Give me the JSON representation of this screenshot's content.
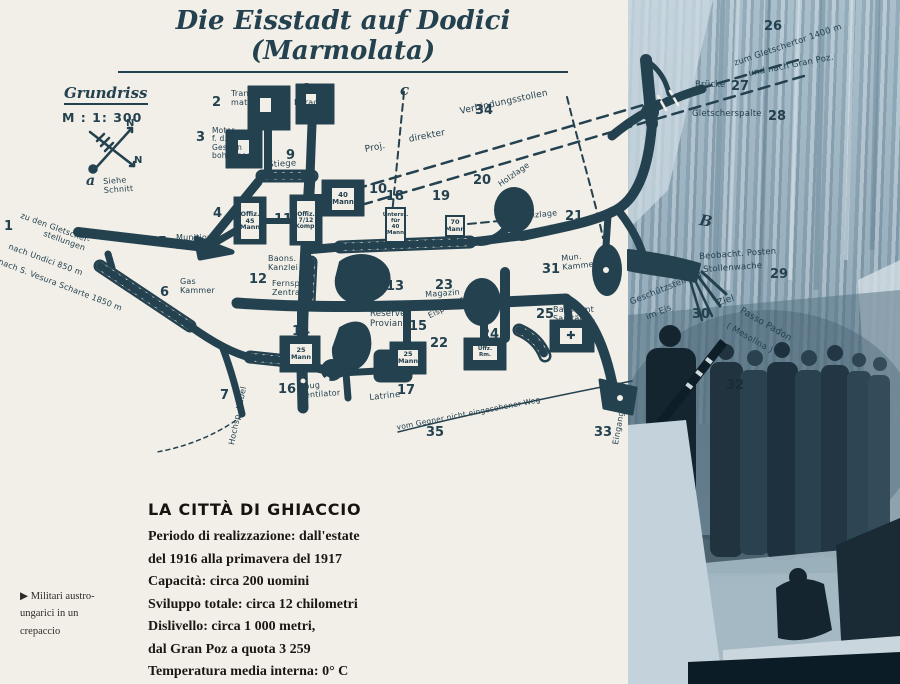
{
  "title": "Die Eisstadt auf Dodici (Marmolata)",
  "legend": {
    "name": "Grundriss",
    "scale": "M : 1: 300",
    "compass_n1": "N",
    "compass_n2": "N"
  },
  "caption": {
    "heading": "LA CITTÀ DI GHIACCIO",
    "lines": [
      "Periodo di realizzazione: dall'estate",
      "del 1916 alla primavera del 1917",
      "Capacità: circa 200 uomini",
      "Sviluppo totale: circa 12 chilometri",
      "Dislivello: circa 1 000 metri,",
      "dal Gran Poz a quota 3 259",
      "Temperatura media interna: 0° C"
    ]
  },
  "photo_note": {
    "marker": "▶",
    "lines": [
      "Militari austro-",
      "ungarici in un",
      "crepaccio"
    ]
  },
  "colors": {
    "ink": "#24414f",
    "paper": "#f2efe8",
    "photo_dark": "#15262f"
  },
  "map_labels": [
    {
      "t": "1",
      "x": 4,
      "y": 220,
      "s": 13,
      "n": 1
    },
    {
      "t": "2",
      "x": 212,
      "y": 96,
      "s": 13,
      "n": 1
    },
    {
      "t": "3",
      "x": 196,
      "y": 131,
      "s": 13,
      "n": 1
    },
    {
      "t": "4",
      "x": 213,
      "y": 207,
      "s": 13,
      "n": 1
    },
    {
      "t": "5",
      "x": 158,
      "y": 236,
      "s": 13,
      "n": 1
    },
    {
      "t": "6",
      "x": 160,
      "y": 286,
      "s": 13,
      "n": 1
    },
    {
      "t": "7",
      "x": 220,
      "y": 389,
      "s": 13,
      "n": 1
    },
    {
      "t": "8",
      "x": 302,
      "y": 83,
      "s": 13,
      "n": 1
    },
    {
      "t": "9",
      "x": 286,
      "y": 149,
      "s": 13,
      "n": 1
    },
    {
      "t": "10",
      "x": 369,
      "y": 183,
      "s": 13,
      "n": 1
    },
    {
      "t": "11",
      "x": 274,
      "y": 213,
      "s": 13,
      "n": 1
    },
    {
      "t": "12",
      "x": 249,
      "y": 273,
      "s": 13,
      "n": 1
    },
    {
      "t": "13",
      "x": 386,
      "y": 280,
      "s": 13,
      "n": 1
    },
    {
      "t": "14",
      "x": 292,
      "y": 325,
      "s": 13,
      "n": 1
    },
    {
      "t": "15",
      "x": 409,
      "y": 320,
      "s": 13,
      "n": 1
    },
    {
      "t": "16",
      "x": 278,
      "y": 383,
      "s": 13,
      "n": 1
    },
    {
      "t": "17",
      "x": 397,
      "y": 384,
      "s": 13,
      "n": 1
    },
    {
      "t": "18",
      "x": 386,
      "y": 190,
      "s": 13,
      "n": 1
    },
    {
      "t": "19",
      "x": 432,
      "y": 190,
      "s": 13,
      "n": 1
    },
    {
      "t": "20",
      "x": 473,
      "y": 174,
      "s": 13,
      "n": 1
    },
    {
      "t": "21",
      "x": 565,
      "y": 210,
      "s": 13,
      "n": 1
    },
    {
      "t": "22",
      "x": 430,
      "y": 337,
      "s": 13,
      "n": 1
    },
    {
      "t": "23",
      "x": 435,
      "y": 279,
      "s": 13,
      "n": 1
    },
    {
      "t": "24",
      "x": 481,
      "y": 328,
      "s": 13,
      "n": 1
    },
    {
      "t": "25",
      "x": 536,
      "y": 308,
      "s": 13,
      "n": 1
    },
    {
      "t": "26",
      "x": 764,
      "y": 20,
      "s": 13,
      "n": 1
    },
    {
      "t": "27",
      "x": 731,
      "y": 80,
      "s": 13,
      "n": 1
    },
    {
      "t": "28",
      "x": 768,
      "y": 110,
      "s": 13,
      "n": 1
    },
    {
      "t": "29",
      "x": 770,
      "y": 268,
      "s": 13,
      "n": 1
    },
    {
      "t": "30",
      "x": 692,
      "y": 308,
      "s": 13,
      "n": 1
    },
    {
      "t": "31",
      "x": 542,
      "y": 263,
      "s": 13,
      "n": 1
    },
    {
      "t": "32",
      "x": 726,
      "y": 379,
      "s": 13,
      "n": 1,
      "c": "dark"
    },
    {
      "t": "33",
      "x": 594,
      "y": 426,
      "s": 13,
      "n": 1
    },
    {
      "t": "34",
      "x": 475,
      "y": 104,
      "s": 13,
      "n": 1
    },
    {
      "t": "35",
      "x": 426,
      "y": 426,
      "s": 13,
      "n": 1
    },
    {
      "t": "a",
      "x": 86,
      "y": 174,
      "s": 14,
      "i": 1
    },
    {
      "t": "Siehe\nSchnitt",
      "x": 103,
      "y": 178,
      "s": 8,
      "r": -4
    },
    {
      "t": "c",
      "x": 400,
      "y": 82,
      "s": 15,
      "i": 1
    },
    {
      "t": "B",
      "x": 701,
      "y": 212,
      "s": 15,
      "i": 1,
      "r": 10
    },
    {
      "t": "Transfor-\nmator",
      "x": 231,
      "y": 90,
      "s": 8
    },
    {
      "t": "Motor\nf. d.\nGestein\nbohrmasch.",
      "x": 212,
      "y": 127,
      "s": 7.5
    },
    {
      "t": "Baracke",
      "x": 294,
      "y": 99,
      "s": 8
    },
    {
      "t": "Stiege",
      "x": 268,
      "y": 161,
      "s": 8.5,
      "r": -3
    },
    {
      "t": "zu den Gletscher-",
      "x": 22,
      "y": 212,
      "s": 8,
      "r": 20
    },
    {
      "t": "stellungen",
      "x": 45,
      "y": 230,
      "s": 8,
      "r": 20
    },
    {
      "t": "nach Undici 850 m",
      "x": 10,
      "y": 243,
      "s": 8,
      "r": 20
    },
    {
      "t": "nach S. Vesura Scharte 1850 m",
      "x": 0,
      "y": 258,
      "s": 8,
      "r": 21
    },
    {
      "t": "Proj.",
      "x": 364,
      "y": 145,
      "s": 9,
      "r": -11
    },
    {
      "t": "direkter",
      "x": 408,
      "y": 135,
      "s": 9,
      "r": -11
    },
    {
      "t": "Verbindungsstollen",
      "x": 459,
      "y": 107,
      "s": 9,
      "r": -12
    },
    {
      "t": "Holzlage",
      "x": 497,
      "y": 182,
      "s": 8,
      "r": -35
    },
    {
      "t": "Holzlage",
      "x": 521,
      "y": 213,
      "s": 8,
      "r": -6
    },
    {
      "t": "stufen",
      "x": 536,
      "y": 227,
      "s": 8,
      "r": -8
    },
    {
      "t": "Mun.\nKammer",
      "x": 561,
      "y": 255,
      "s": 8,
      "r": -6
    },
    {
      "t": "Munitions\nraum",
      "x": 176,
      "y": 234,
      "s": 8
    },
    {
      "t": "Gas\nKammer",
      "x": 180,
      "y": 278,
      "s": 8
    },
    {
      "t": "Baons.\nKanzlei",
      "x": 268,
      "y": 255,
      "s": 8
    },
    {
      "t": "Fernspr.\nZentrale",
      "x": 272,
      "y": 280,
      "s": 8
    },
    {
      "t": "Vorrats\nraum",
      "x": 357,
      "y": 270,
      "s": 8.5
    },
    {
      "t": "Magazin",
      "x": 425,
      "y": 291,
      "s": 8,
      "r": -4
    },
    {
      "t": "Eispfeiler",
      "x": 427,
      "y": 313,
      "s": 8,
      "r": -27
    },
    {
      "t": "Reserve\nProviant",
      "x": 370,
      "y": 310,
      "s": 8.5
    },
    {
      "t": "Baon Amt\nSanität",
      "x": 553,
      "y": 306,
      "s": 8
    },
    {
      "t": "Saug\nventilator",
      "x": 299,
      "y": 383,
      "s": 8,
      "r": -4
    },
    {
      "t": "Latrine",
      "x": 369,
      "y": 394,
      "s": 8.5,
      "r": -6
    },
    {
      "t": "Hochsp. Kabel",
      "x": 228,
      "y": 444,
      "s": 8,
      "r": -78
    },
    {
      "t": "vom Gegner nicht eingesehener Weg",
      "x": 396,
      "y": 424,
      "s": 7.5,
      "r": -11
    },
    {
      "t": "Eingang",
      "x": 612,
      "y": 444,
      "s": 8,
      "r": -80
    },
    {
      "t": "zum Gletschertor 1400 m",
      "x": 733,
      "y": 60,
      "s": 8.5,
      "r": -19
    },
    {
      "t": "und nach Gran Poz.",
      "x": 748,
      "y": 70,
      "s": 8.5,
      "r": -11
    },
    {
      "t": "Brücke",
      "x": 695,
      "y": 81,
      "s": 8.5
    },
    {
      "t": "Gletscherspalte",
      "x": 692,
      "y": 110,
      "s": 8.5
    },
    {
      "t": "Beobacht. Posten",
      "x": 699,
      "y": 253,
      "s": 8.5,
      "r": -4
    },
    {
      "t": "Stollenwache",
      "x": 703,
      "y": 266,
      "s": 8.5,
      "r": -4
    },
    {
      "t": "Geschützstellung",
      "x": 629,
      "y": 299,
      "s": 8.5,
      "r": -22
    },
    {
      "t": "im Eis",
      "x": 645,
      "y": 314,
      "s": 8.5,
      "r": -22
    },
    {
      "t": "Ziel",
      "x": 716,
      "y": 299,
      "s": 9,
      "r": -18
    },
    {
      "t": "Passo Padon",
      "x": 743,
      "y": 306,
      "s": 9,
      "r": 30
    },
    {
      "t": "( Mesolina )",
      "x": 729,
      "y": 322,
      "s": 8.5,
      "r": 30
    }
  ],
  "chamber_boxes": [
    {
      "x": 330,
      "y": 186,
      "w": 26,
      "h": 26,
      "fs": 7,
      "lines": [
        "40",
        "Mann"
      ]
    },
    {
      "x": 239,
      "y": 201,
      "w": 22,
      "h": 40,
      "fs": 6.5,
      "lines": [
        "Offiz.",
        "45",
        "Mann"
      ]
    },
    {
      "x": 295,
      "y": 199,
      "w": 22,
      "h": 44,
      "fs": 6,
      "lines": [
        "Offiz.",
        "7/12",
        "Komp."
      ]
    },
    {
      "x": 385,
      "y": 207,
      "w": 21,
      "h": 36,
      "fs": 5.5,
      "lines": [
        "Unterst.",
        "für 40",
        "Mann"
      ]
    },
    {
      "x": 445,
      "y": 215,
      "w": 20,
      "h": 22,
      "fs": 6.5,
      "lines": [
        "70",
        "Mann"
      ]
    },
    {
      "x": 288,
      "y": 342,
      "w": 26,
      "h": 24,
      "fs": 6.5,
      "lines": [
        "25",
        "Mann"
      ]
    },
    {
      "x": 396,
      "y": 348,
      "w": 24,
      "h": 20,
      "fs": 6.5,
      "lines": [
        "25",
        "Mann"
      ]
    },
    {
      "x": 471,
      "y": 344,
      "w": 28,
      "h": 18,
      "fs": 5.5,
      "lines": [
        "Uffz.",
        "Rm."
      ]
    },
    {
      "x": 558,
      "y": 326,
      "w": 26,
      "h": 20,
      "fs": 11,
      "lines": [
        "✚"
      ]
    },
    {
      "x": 258,
      "y": 96,
      "w": 15,
      "h": 18,
      "fs": 6,
      "lines": []
    },
    {
      "x": 304,
      "y": 92,
      "w": 14,
      "h": 14,
      "fs": 6,
      "lines": []
    },
    {
      "x": 236,
      "y": 138,
      "w": 15,
      "h": 18,
      "fs": 6,
      "lines": []
    }
  ]
}
